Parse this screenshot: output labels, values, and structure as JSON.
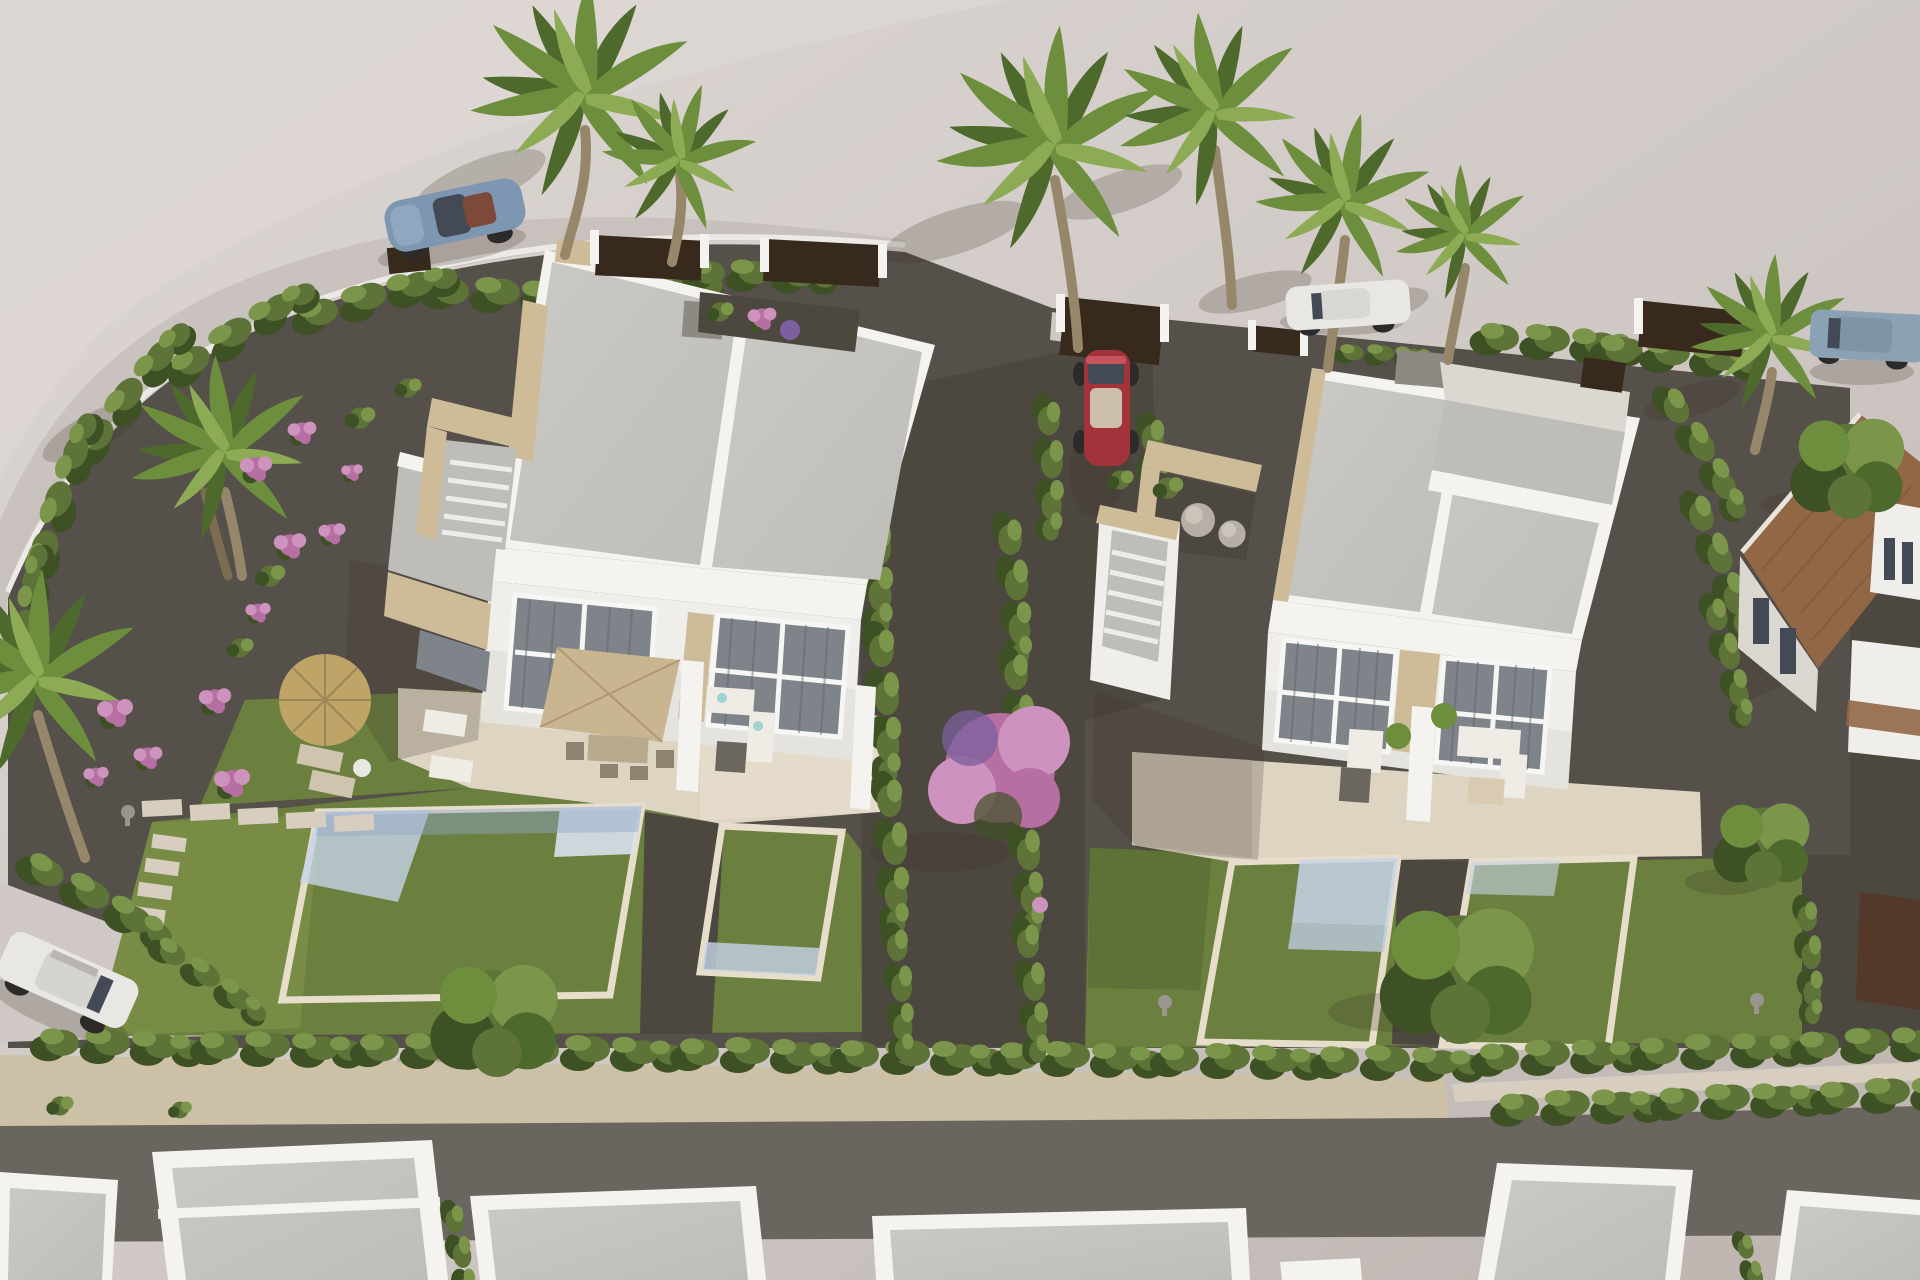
{
  "meta": {
    "title": "Aerial 3D architectural render",
    "description": "Bird's-eye 3D visualization of a residential development: two pairs of modern white semi-detached villas with flat roofs, beige stone accents, private pools, lawns and cypress hedges; palm trees, parked cars on the surrounding road, a terracotta-roofed neighbour house at right and a row of white roofs along the bottom street."
  },
  "palette": {
    "groundLight": "#ddd7d3",
    "ground": "#cfc8c4",
    "groundDark": "#bdb4b0",
    "plotGravel": "#55504a",
    "pathDark": "#4c473f",
    "stoneWall": "#ccc0a6",
    "stonePath": "#d7cec0",
    "roadDark": "#6b655f",
    "lawn": "#6b7f3e",
    "lawnLight": "#7c9049",
    "lawnDark": "#526430",
    "hedge": "#5e7337",
    "hedgeLight": "#7b954a",
    "hedgeDark": "#3e5124",
    "roof": "#cac9c5",
    "roofShade": "#bebdb8",
    "parapet": "#f4f3f0",
    "white": "#efeeea",
    "wallShade": "#dbd8d2",
    "beige": "#cebc99",
    "beigeShade": "#b2a07c",
    "glass": "#7f838a",
    "terrace": "#ded4c2",
    "terraceLight": "#e8e0cf",
    "terraceShade": "#c9bfae",
    "poolWater": "#a9bdd9",
    "poolLight": "#c6d3e7",
    "poolDeep": "#93a9c9",
    "parasol": "#c9b58f",
    "straw": "#bfa468",
    "furnWhite": "#efece6",
    "furnDark": "#6b675f",
    "fence": "#38291d",
    "terracotta": "#926746",
    "trunk": "#97876a",
    "palm1": "#6d8e3c",
    "palm2": "#4d6a2c",
    "palm3": "#8cab54",
    "pink1": "#b66fa3",
    "pink2": "#cd92bd",
    "purple": "#7b5f9e",
    "carBlue": "#7d97b2",
    "carRed": "#a2333b",
    "carWhite": "#e9e7e4",
    "suvBlue": "#8ba2b5",
    "tire": "#2c2b29",
    "carGlass": "#434a55",
    "interior": "#7d4a3a",
    "chimney": "#8d8a84",
    "stoneBall": "#b5afa6",
    "shadow": "#3b342c",
    "pergola": "#54392a"
  },
  "scene": {
    "objects": [
      {
        "id": "villa-pair-left",
        "label": "White semi-detached villa pair (left)"
      },
      {
        "id": "villa-pair-right",
        "label": "White semi-detached villa pair (right)"
      },
      {
        "id": "pool-left-large",
        "label": "Large private pool, left garden"
      },
      {
        "id": "pool-left-small",
        "label": "Small private pool, left garden"
      },
      {
        "id": "pool-right-1",
        "label": "Pool with sun platform, right garden"
      },
      {
        "id": "pool-right-2",
        "label": "Pool, far right garden"
      },
      {
        "id": "straw-parasol",
        "label": "Round straw parasol with sun loungers"
      },
      {
        "id": "beige-parasol",
        "label": "Square beige patio parasol with dining set"
      },
      {
        "id": "blue-roadster",
        "label": "Blue convertible sports car on road"
      },
      {
        "id": "red-convertible",
        "label": "Red convertible parked in driveway"
      },
      {
        "id": "white-car",
        "label": "White car parked under palms"
      },
      {
        "id": "blue-suv",
        "label": "Blue-grey SUV, top right road"
      },
      {
        "id": "white-suv",
        "label": "White SUV in left driveway"
      },
      {
        "id": "terracotta-house",
        "label": "Neighbouring house with terracotta tiled roof"
      },
      {
        "id": "bottom-roofs",
        "label": "Row of white flat roofs along bottom street"
      },
      {
        "id": "hedges",
        "label": "Cypress hedge boundaries"
      },
      {
        "id": "palm-trees",
        "label": "Fan palm trees"
      },
      {
        "id": "bougainvillea",
        "label": "Pink bougainvillea tree and flower bushes"
      },
      {
        "id": "stone-wall",
        "label": "Sand-coloured boundary wall"
      },
      {
        "id": "street",
        "label": "Dark rear street"
      }
    ]
  }
}
